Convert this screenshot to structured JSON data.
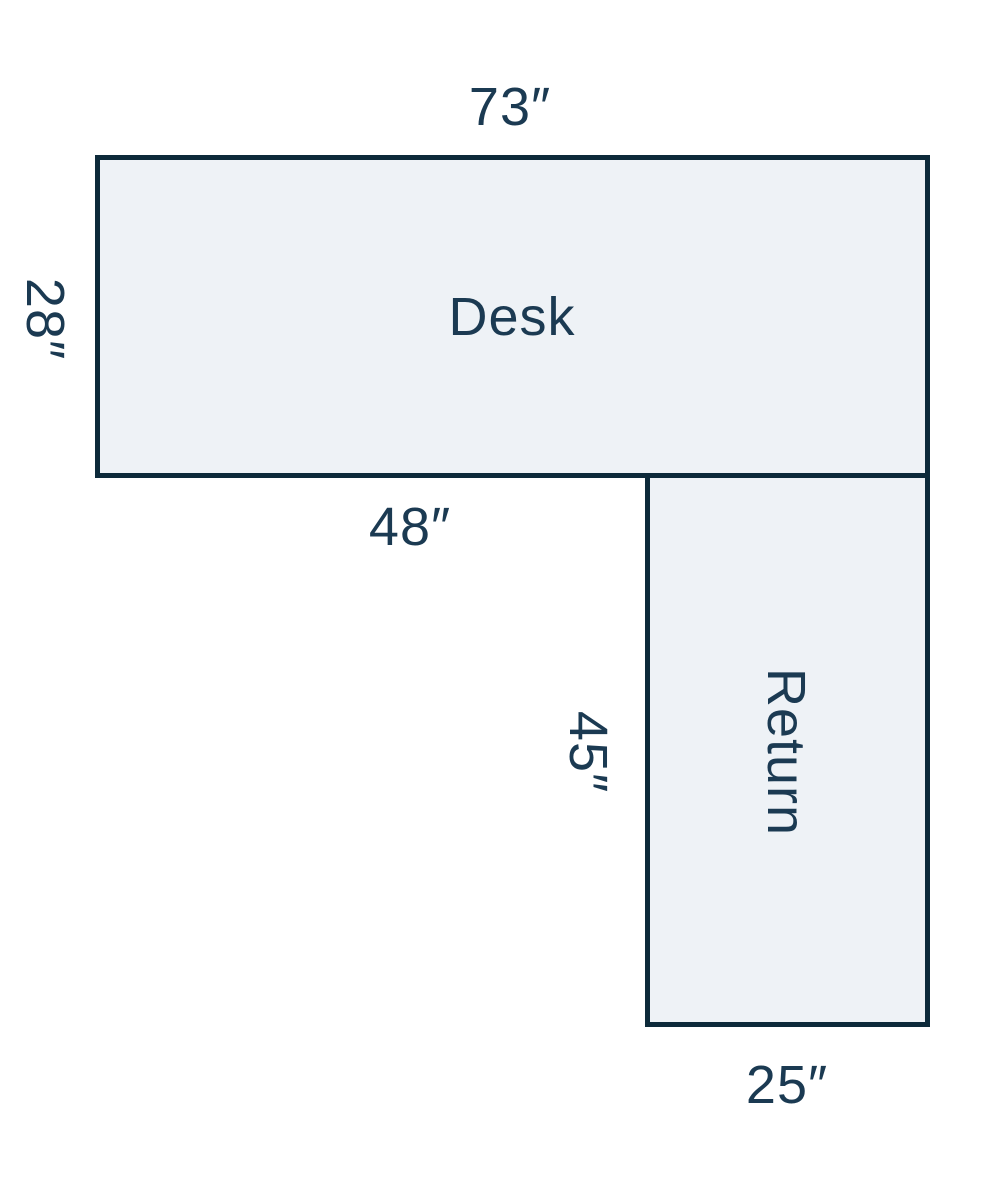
{
  "diagram": {
    "desk": {
      "label": "Desk",
      "top_dimension": "73″",
      "left_dimension": "28″",
      "bottom_dimension": "48″"
    },
    "return": {
      "label": "Return",
      "left_dimension": "45″",
      "bottom_dimension": "25″"
    }
  },
  "colors": {
    "outline": "#0d2a3a",
    "shape_fill": "#eef2f6",
    "label_text": "#1b3a52",
    "background": "#ffffff"
  }
}
